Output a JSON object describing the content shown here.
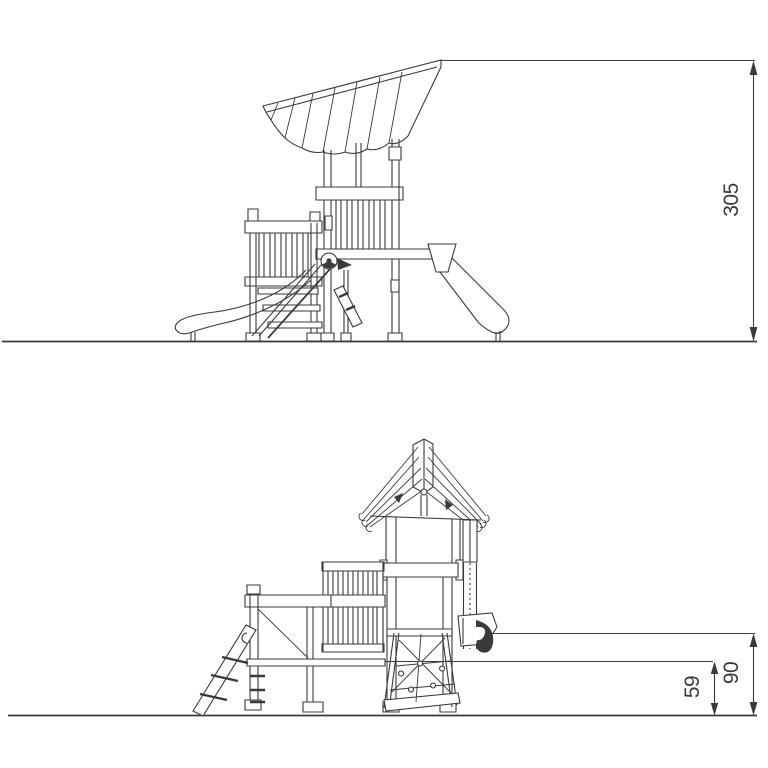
{
  "drawing": {
    "colors": {
      "line": "#3a3a3a",
      "background": "#ffffff"
    },
    "upper_view": {
      "height_dim_label": "305"
    },
    "lower_view": {
      "upper_platform_dim_label": "90",
      "lower_platform_dim_label": "59"
    }
  }
}
